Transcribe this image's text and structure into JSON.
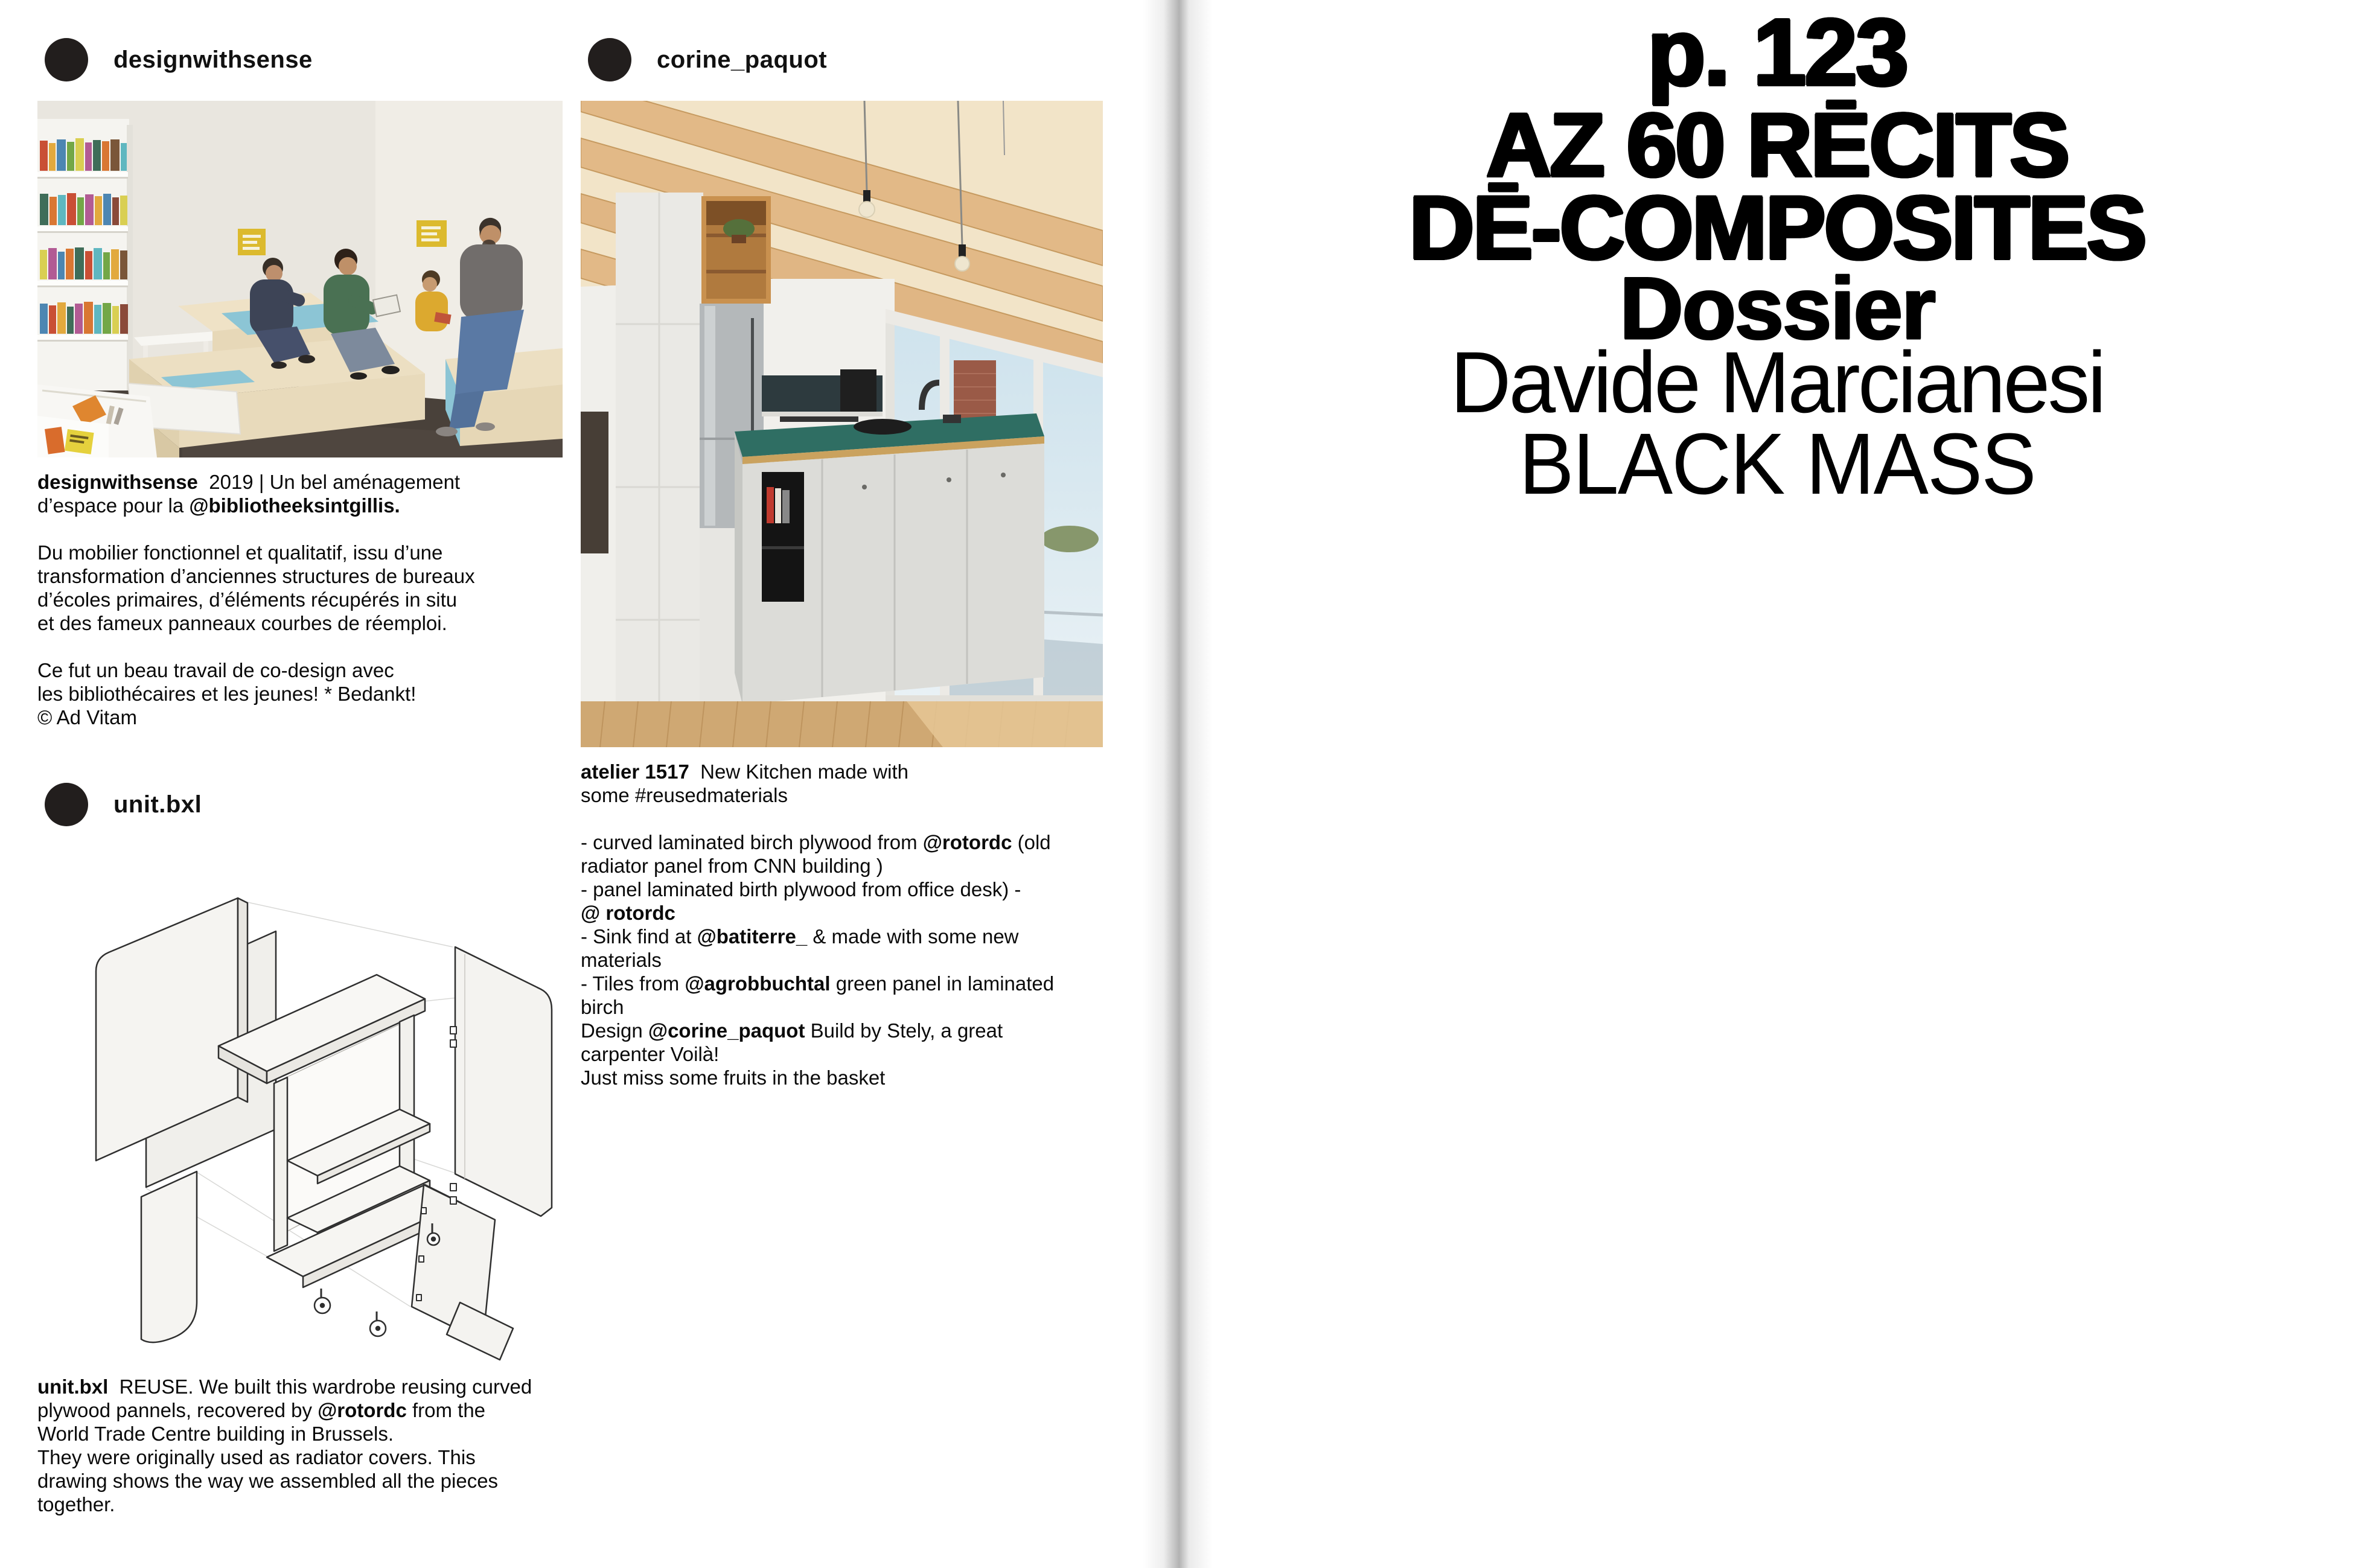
{
  "colors": {
    "text": "#000000",
    "background": "#ffffff",
    "avatar": "#221e1d",
    "gutter_shadow": "#8f8f8f",
    "accent_blue": "#8cc5d5",
    "accent_teal": "#2f6e63",
    "wood": "#e2b987"
  },
  "left_page": {
    "posts": [
      {
        "username": "designwithsense",
        "image_alt": "library interior photo: tiered plywood seating with blue accents, four people reading, white bookshelves with colorful books, dark floor",
        "caption_lines": [
          [
            {
              "t": "designwithsense",
              "b": true
            },
            {
              "t": "  2019 | Un bel aménagement",
              "b": false
            }
          ],
          [
            {
              "t": "d’espace pour la ",
              "b": false
            },
            {
              "t": "@bibliotheeksintgillis.",
              "b": true
            }
          ],
          [],
          [
            {
              "t": "Du mobilier fonctionnel et qualitatif, issu d’une",
              "b": false
            }
          ],
          [
            {
              "t": "transformation d’anciennes structures de bureaux",
              "b": false
            }
          ],
          [
            {
              "t": "d’écoles primaires, d’éléments récupérés in situ",
              "b": false
            }
          ],
          [
            {
              "t": "et des fameux panneaux courbes de réemploi.",
              "b": false
            }
          ],
          [],
          [
            {
              "t": "Ce fut un beau travail de co-design avec",
              "b": false
            }
          ],
          [
            {
              "t": "les bibliothécaires et les jeunes! * Bedankt!",
              "b": false
            }
          ],
          [
            {
              "t": "© Ad Vitam",
              "b": false
            }
          ]
        ]
      },
      {
        "username": "corine_paquot",
        "image_alt": "kitchen photo: wooden beam ceiling, white cabinets, fridge, island with teal countertop, large windows with brick pillar, wooden floor, hanging bulbs",
        "caption_lines": [
          [
            {
              "t": "atelier 1517",
              "b": true
            },
            {
              "t": "  New Kitchen made with",
              "b": false
            }
          ],
          [
            {
              "t": "some #reusedmaterials",
              "b": false
            }
          ],
          [],
          [
            {
              "t": "- curved laminated birch plywood from ",
              "b": false
            },
            {
              "t": "@rotordc",
              "b": true
            },
            {
              "t": " (old",
              "b": false
            }
          ],
          [
            {
              "t": "radiator panel from CNN building )",
              "b": false
            }
          ],
          [
            {
              "t": "- panel laminated birth plywood from office desk) -",
              "b": false
            }
          ],
          [
            {
              "t": "@ rotordc",
              "b": true
            }
          ],
          [
            {
              "t": "- Sink find at ",
              "b": false
            },
            {
              "t": "@batiterre_",
              "b": true
            },
            {
              "t": " & made with some new",
              "b": false
            }
          ],
          [
            {
              "t": "materials",
              "b": false
            }
          ],
          [
            {
              "t": "- Tiles from ",
              "b": false
            },
            {
              "t": "@agrobbuchtal",
              "b": true
            },
            {
              "t": " green panel in laminated",
              "b": false
            }
          ],
          [
            {
              "t": "birch",
              "b": false
            }
          ],
          [
            {
              "t": "Design ",
              "b": false
            },
            {
              "t": "@corine_paquot",
              "b": true
            },
            {
              "t": " Build by Stely, a great",
              "b": false
            }
          ],
          [
            {
              "t": "carpenter Voilà!",
              "b": false
            }
          ],
          [
            {
              "t": "Just miss some fruits in the basket",
              "b": false
            }
          ]
        ]
      },
      {
        "username": "unit.bxl",
        "image_alt": "exploded isometric line drawing of a wardrobe made of curved plywood panels, shelves and caster wheels",
        "caption_lines": [
          [
            {
              "t": "unit.bxl",
              "b": true
            },
            {
              "t": "  REUSE. We built this wardrobe reusing curved",
              "b": false
            }
          ],
          [
            {
              "t": "plywood pannels, recovered by ",
              "b": false
            },
            {
              "t": "@rotordc",
              "b": true
            },
            {
              "t": " from the",
              "b": false
            }
          ],
          [
            {
              "t": "World Trade Centre building in Brussels.",
              "b": false
            }
          ],
          [
            {
              "t": "They were originally used as radiator covers. This",
              "b": false
            }
          ],
          [
            {
              "t": "drawing shows the way we assembled all the pieces",
              "b": false
            }
          ],
          [
            {
              "t": "together.",
              "b": false
            }
          ]
        ]
      }
    ]
  },
  "right_page": {
    "lines": [
      {
        "text": "p. 123",
        "weight": "heavy"
      },
      {
        "text": "AZ 60 RĒCITS",
        "weight": "heavy"
      },
      {
        "text": "DĒ-COMPOSITES",
        "weight": "heavy"
      },
      {
        "text": "Dossier",
        "weight": "bold"
      },
      {
        "text": "Davide Marcianesi",
        "weight": "regular"
      },
      {
        "text": "BLACK MASS",
        "weight": "light"
      }
    ]
  }
}
